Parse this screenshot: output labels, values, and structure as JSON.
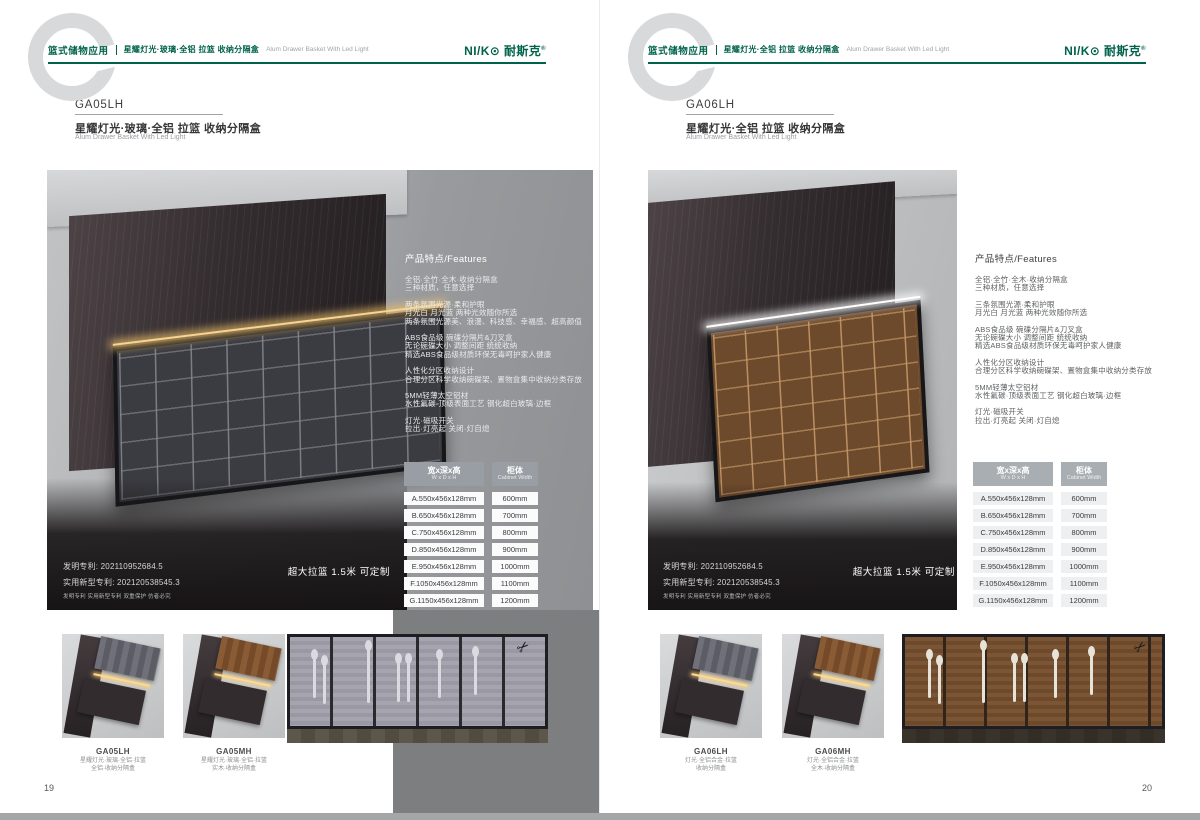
{
  "brand": {
    "logo": "NI/K⊙ 耐斯克",
    "reg": "®",
    "accent_color": "#00624b"
  },
  "icons": {
    "scissors": "✂"
  },
  "left": {
    "page_number": "19",
    "header": {
      "section": "篮式储物应用",
      "title": "星耀灯光·玻璃·全铝 拉篮 收纳分隔盒",
      "title_en": "Alum Drawer Basket With Led Light"
    },
    "product": {
      "code": "GA05LH",
      "name_cn": "星耀灯光·玻璃·全铝 拉篮 收纳分隔盒",
      "name_en": "Alum Drawer Basket With Led Light"
    },
    "features": {
      "heading": "产品特点/Features",
      "groups": [
        {
          "lines": [
            "全铝·全竹·全木·收纳分隔盒",
            "三种材质，任意选择"
          ]
        },
        {
          "lines": [
            "两条氛围光源·柔和护眼",
            "月光白 月光蓝 两种光效随你所选",
            "两条氛围光源美、浪漫、科技感、幸福感、超高颜值"
          ]
        },
        {
          "lines": [
            "ABS食品级 碗碟分隔片&刀叉盒",
            "无论碗碟大小 调整间距 统统收纳",
            "精选ABS食品级材质环保无毒呵护家人健康"
          ]
        },
        {
          "lines": [
            "人性化分区收纳设计",
            "合理分区科学收纳碗碟架、置物盒集中收纳分类存放"
          ]
        },
        {
          "lines": [
            "5MM轻薄太空铝材",
            "水性氟碳·顶级表面工艺 钢化超白玻璃·边框"
          ]
        },
        {
          "lines": [
            "灯光·磁吸开关",
            "拉出·灯亮起 关闭·灯自熄"
          ]
        }
      ]
    },
    "patent": {
      "invention": "发明专利: 202110952684.5",
      "utility": "实用新型专利: 202120538545.3",
      "note": "发明专利 实用新型专利 双重保护 仿者必究"
    },
    "badge": "超大拉篮 1.5米 可定制",
    "spec_table": {
      "col1_header": "宽x深x高",
      "col1_sub": "W x D x H",
      "col2_header": "柜体",
      "col2_sub": "Cabinet Width",
      "rows": [
        [
          "A.550x456x128mm",
          "600mm"
        ],
        [
          "B.650x456x128mm",
          "700mm"
        ],
        [
          "C.750x456x128mm",
          "800mm"
        ],
        [
          "D.850x456x128mm",
          "900mm"
        ],
        [
          "E.950x456x128mm",
          "1000mm"
        ],
        [
          "F.1050x456x128mm",
          "1100mm"
        ],
        [
          "G.1150x456x128mm",
          "1200mm"
        ]
      ]
    },
    "thumbs": [
      {
        "code": "GA05LH",
        "line1": "星耀灯光·玻璃·全铝·拉篮",
        "line2": "全铝·收纳分隔盒"
      },
      {
        "code": "GA05MH",
        "line1": "星耀灯光·玻璃·全铝·拉篮",
        "line2": "实木·收纳分隔盒"
      }
    ]
  },
  "right": {
    "page_number": "20",
    "header": {
      "section": "篮式储物应用",
      "title": "星耀灯光·全铝 拉篮 收纳分隔盒",
      "title_en": "Alum Drawer Basket With Led Light"
    },
    "product": {
      "code": "GA06LH",
      "name_cn": "星耀灯光·全铝 拉篮 收纳分隔盒",
      "name_en": "Alum Drawer Basket With Led Light"
    },
    "features": {
      "heading": "产品特点/Features",
      "groups": [
        {
          "lines": [
            "全铝·全竹·全木·收纳分隔盒",
            "三种材质，任意选择"
          ]
        },
        {
          "lines": [
            "三条氛围光源·柔和护眼",
            "月光白 月光蓝 两种光效随你所选"
          ]
        },
        {
          "lines": [
            "ABS食品级 碗碟分隔片&刀叉盒",
            "无论碗碟大小 调整间距 统统收纳",
            "精选ABS食品级材质环保无毒呵护家人健康"
          ]
        },
        {
          "lines": [
            "人性化分区收纳设计",
            "合理分区科学收纳碗碟架、置物盒集中收纳分类存放"
          ]
        },
        {
          "lines": [
            "5MM轻薄太空铝材",
            "水性氟碳·顶级表面工艺 钢化超白玻璃·边框"
          ]
        },
        {
          "lines": [
            "灯光·磁吸开关",
            "拉出·灯亮起 关闭·灯自熄"
          ]
        }
      ]
    },
    "patent": {
      "invention": "发明专利: 202110952684.5",
      "utility": "实用新型专利: 202120538545.3",
      "note": "发明专利 实用新型专利 双重保护 仿者必究"
    },
    "badge": "超大拉篮 1.5米 可定制",
    "spec_table": {
      "col1_header": "宽x深x高",
      "col1_sub": "W x D x H",
      "col2_header": "柜体",
      "col2_sub": "Cabinet Width",
      "rows": [
        [
          "A.550x456x128mm",
          "600mm"
        ],
        [
          "B.650x456x128mm",
          "700mm"
        ],
        [
          "C.750x456x128mm",
          "800mm"
        ],
        [
          "D.850x456x128mm",
          "900mm"
        ],
        [
          "E.950x456x128mm",
          "1000mm"
        ],
        [
          "F.1050x456x128mm",
          "1100mm"
        ],
        [
          "G.1150x456x128mm",
          "1200mm"
        ]
      ]
    },
    "thumbs": [
      {
        "code": "GA06LH",
        "line1": "灯光·全铝合金·拉篮",
        "line2": "收纳分隔盒"
      },
      {
        "code": "GA06MH",
        "line1": "灯光·全铝合金·拉篮",
        "line2": "全木·收纳分隔盒"
      }
    ]
  }
}
